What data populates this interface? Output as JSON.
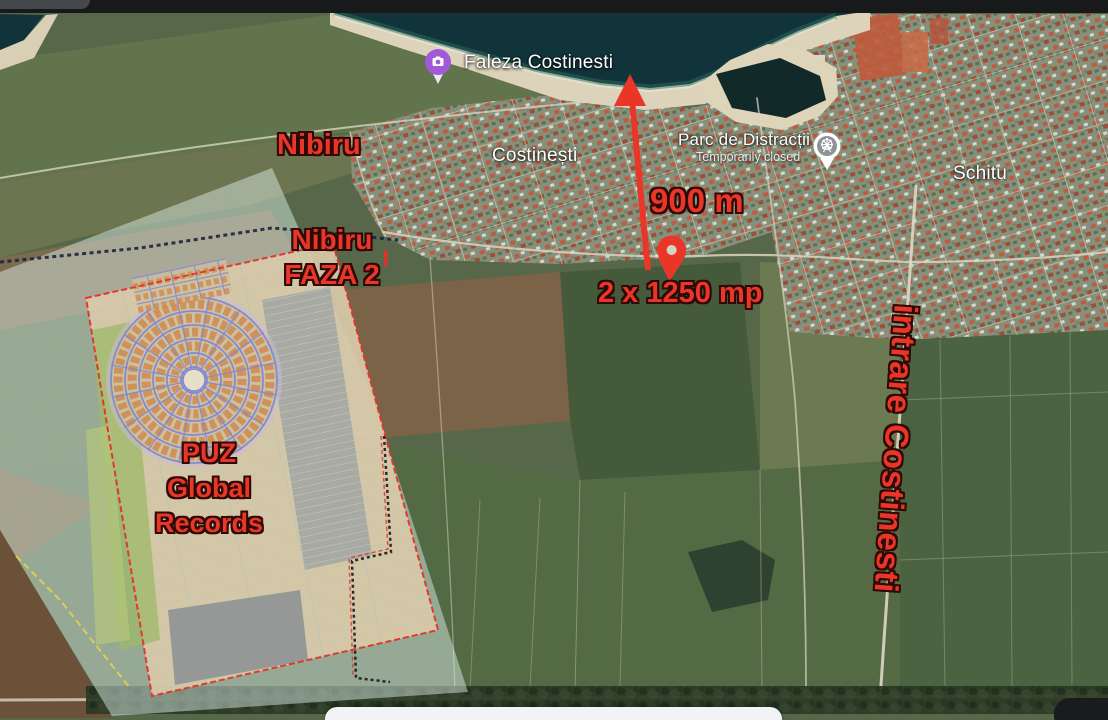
{
  "map_labels": {
    "faleza": "Faleza Costinesti",
    "town": "Costinești",
    "parc": "Parc de Distracții",
    "parc_status": "Temporarily closed",
    "schitu": "Schitu"
  },
  "annotations": {
    "nibiru": "Nibiru",
    "nibiru_faza_line1": "Nibiru",
    "nibiru_faza_line2": "FAZA 2",
    "puz_line1": "PUZ",
    "puz_line2": "Global",
    "puz_line3": "Records",
    "distance": "900 m",
    "area": "2 x 1250 mp",
    "entrance": "intrare Costinesti"
  },
  "icons": {
    "faleza_pin": "camera-photo-pin",
    "parc_pin": "ferris-wheel-pin",
    "marker": "location-pin",
    "arrow": "up-arrow"
  },
  "colors": {
    "annotation_red": "#ea3629",
    "label_white": "#ffffff",
    "photo_pin_purple": "#a259d9",
    "sea_dark_teal": "#11343a",
    "beach_sand": "#dcd3ba",
    "overlay_teal": "#d7e8df",
    "plan_beige": "#d9caa9",
    "top_bar": "#17191b",
    "bottom_bar": "#f1f3f4"
  }
}
